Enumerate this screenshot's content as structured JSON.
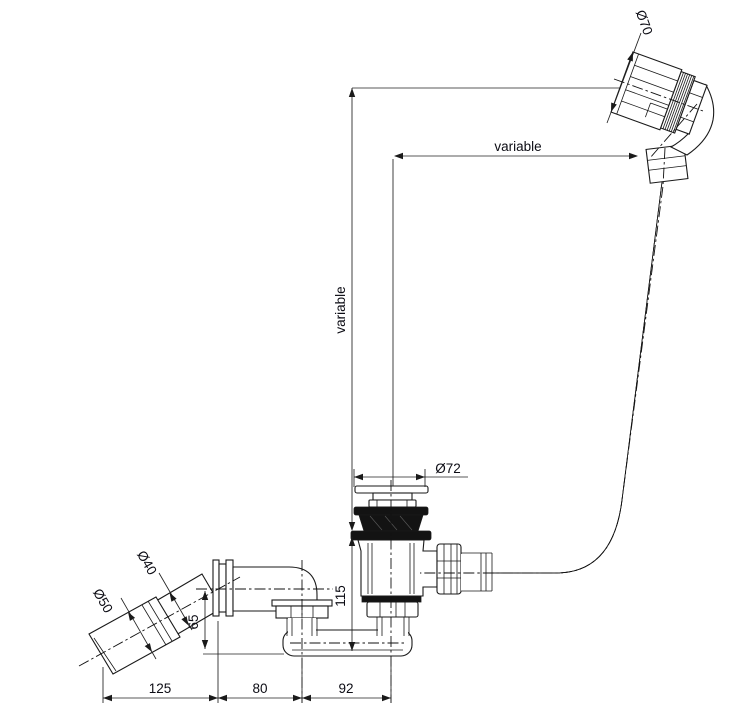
{
  "drawing": {
    "type": "technical-line-drawing",
    "subject": "Bath waste with overflow, flexible hose and outlet elbow - side elevation",
    "colors": {
      "line": "#1a1a1a",
      "dimension_text": "#0c0c14",
      "hose_gray": "#bdbdbd",
      "seal_black": "#131313",
      "background": "#ffffff"
    },
    "dimensions": {
      "overflow_diameter": "Ø70",
      "waste_flange_diameter": "Ø72",
      "outlet_pipe_diameter": "Ø40",
      "outlet_cone_diameter": "Ø50",
      "vertical_variable": "variable",
      "horizontal_variable": "variable",
      "waste_height": "115",
      "outlet_centre_height": "65",
      "bottom_left_span": "125",
      "bottom_middle_span": "80",
      "bottom_right_span": "92"
    }
  }
}
